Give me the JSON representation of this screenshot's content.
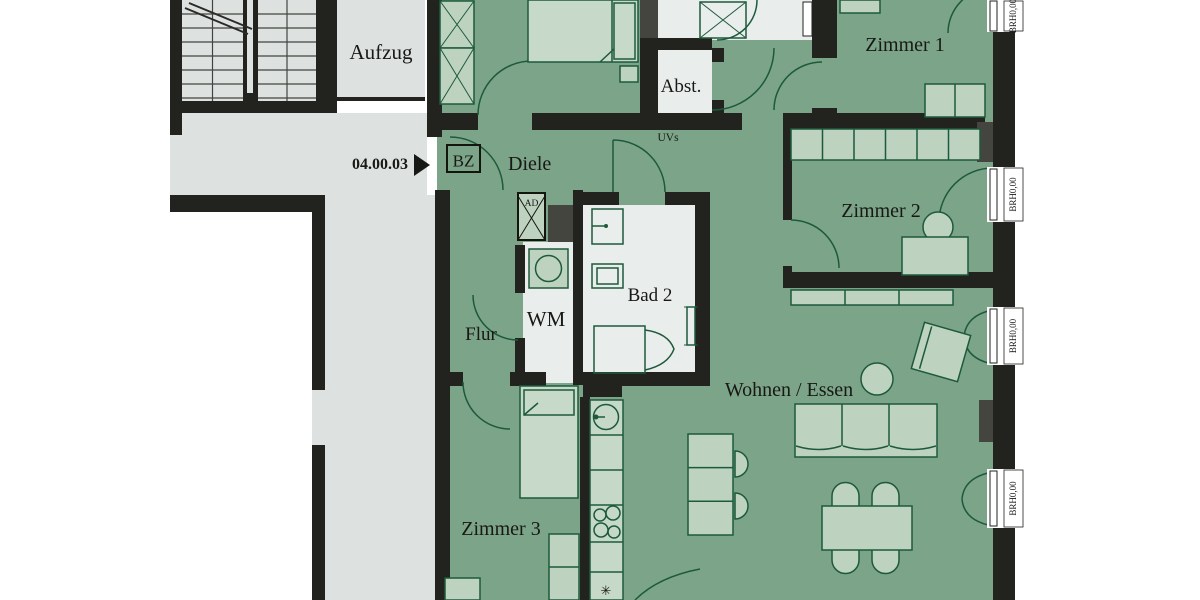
{
  "plan": {
    "unit_number": "04.00.03",
    "rooms": {
      "aufzug": "Aufzug",
      "diele": "Diele",
      "abst": "Abst.",
      "zimmer1": "Zimmer 1",
      "zimmer2": "Zimmer 2",
      "zimmer3": "Zimmer 3",
      "wohnen_essen": "Wohnen / Essen",
      "bad2": "Bad 2",
      "wm": "WM",
      "flur": "Flur"
    },
    "annotations": {
      "bz": "BZ",
      "ad": "AD",
      "uvs": "UVs",
      "dishwasher_symbol": "✳"
    },
    "windows": [
      {
        "label": "BRH0,00"
      },
      {
        "label": "BRH0,00"
      },
      {
        "label": "BRH0,00"
      },
      {
        "label": "BRH0,00"
      }
    ],
    "colors": {
      "wall": "#22221f",
      "apartment_floor": "#7ca489",
      "common_floor": "#dde2e0",
      "wet_room_floor": "#e9edeb",
      "furniture_fill": "#bdd3c0",
      "furniture_stroke": "#1d5a3c",
      "background": "#ffffff"
    }
  }
}
